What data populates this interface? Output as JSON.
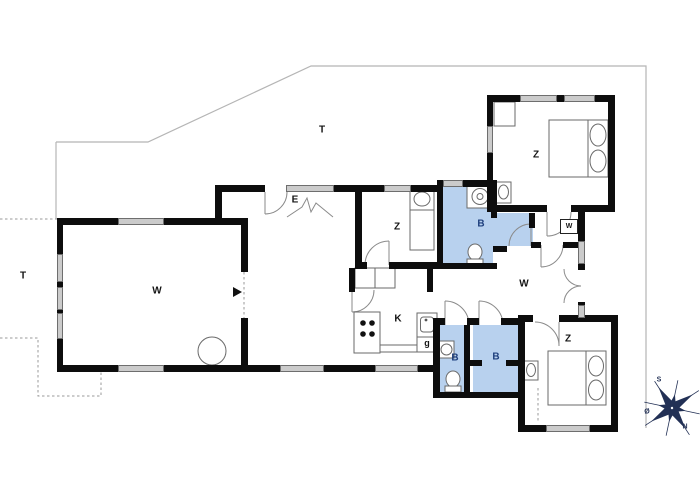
{
  "plan": {
    "type": "holiday-house floor plan",
    "compass_present": true
  },
  "rooms": [
    {
      "id": "terrace-north",
      "label": "T"
    },
    {
      "id": "terrace-west",
      "label": "T"
    },
    {
      "id": "living-room",
      "label": "W"
    },
    {
      "id": "living-dining",
      "label": "W"
    },
    {
      "id": "entrance",
      "label": "E"
    },
    {
      "id": "bedroom-middle",
      "label": "Z"
    },
    {
      "id": "bedroom-northeast",
      "label": "Z"
    },
    {
      "id": "bedroom-southeast",
      "label": "Z"
    },
    {
      "id": "bathroom-main",
      "label": "B"
    },
    {
      "id": "bathroom-left",
      "label": "B"
    },
    {
      "id": "bathroom-right",
      "label": "B"
    },
    {
      "id": "kitchen",
      "label": "K"
    },
    {
      "id": "pantry",
      "label": "g"
    },
    {
      "id": "wardrobe-closet",
      "label": "W"
    }
  ],
  "compass": {
    "south": "S",
    "east": "Ø",
    "north": "N"
  },
  "colors": {
    "wall": "#0d0d0d",
    "window_fill": "#cbcbcb",
    "bathroom_fill": "#b8d1ee",
    "room_label": "#141414",
    "bath_label": "#1e3f7d",
    "compass": "#223055",
    "thin_line": "#8a8a8a",
    "terrace_line": "#b5b5b5"
  }
}
